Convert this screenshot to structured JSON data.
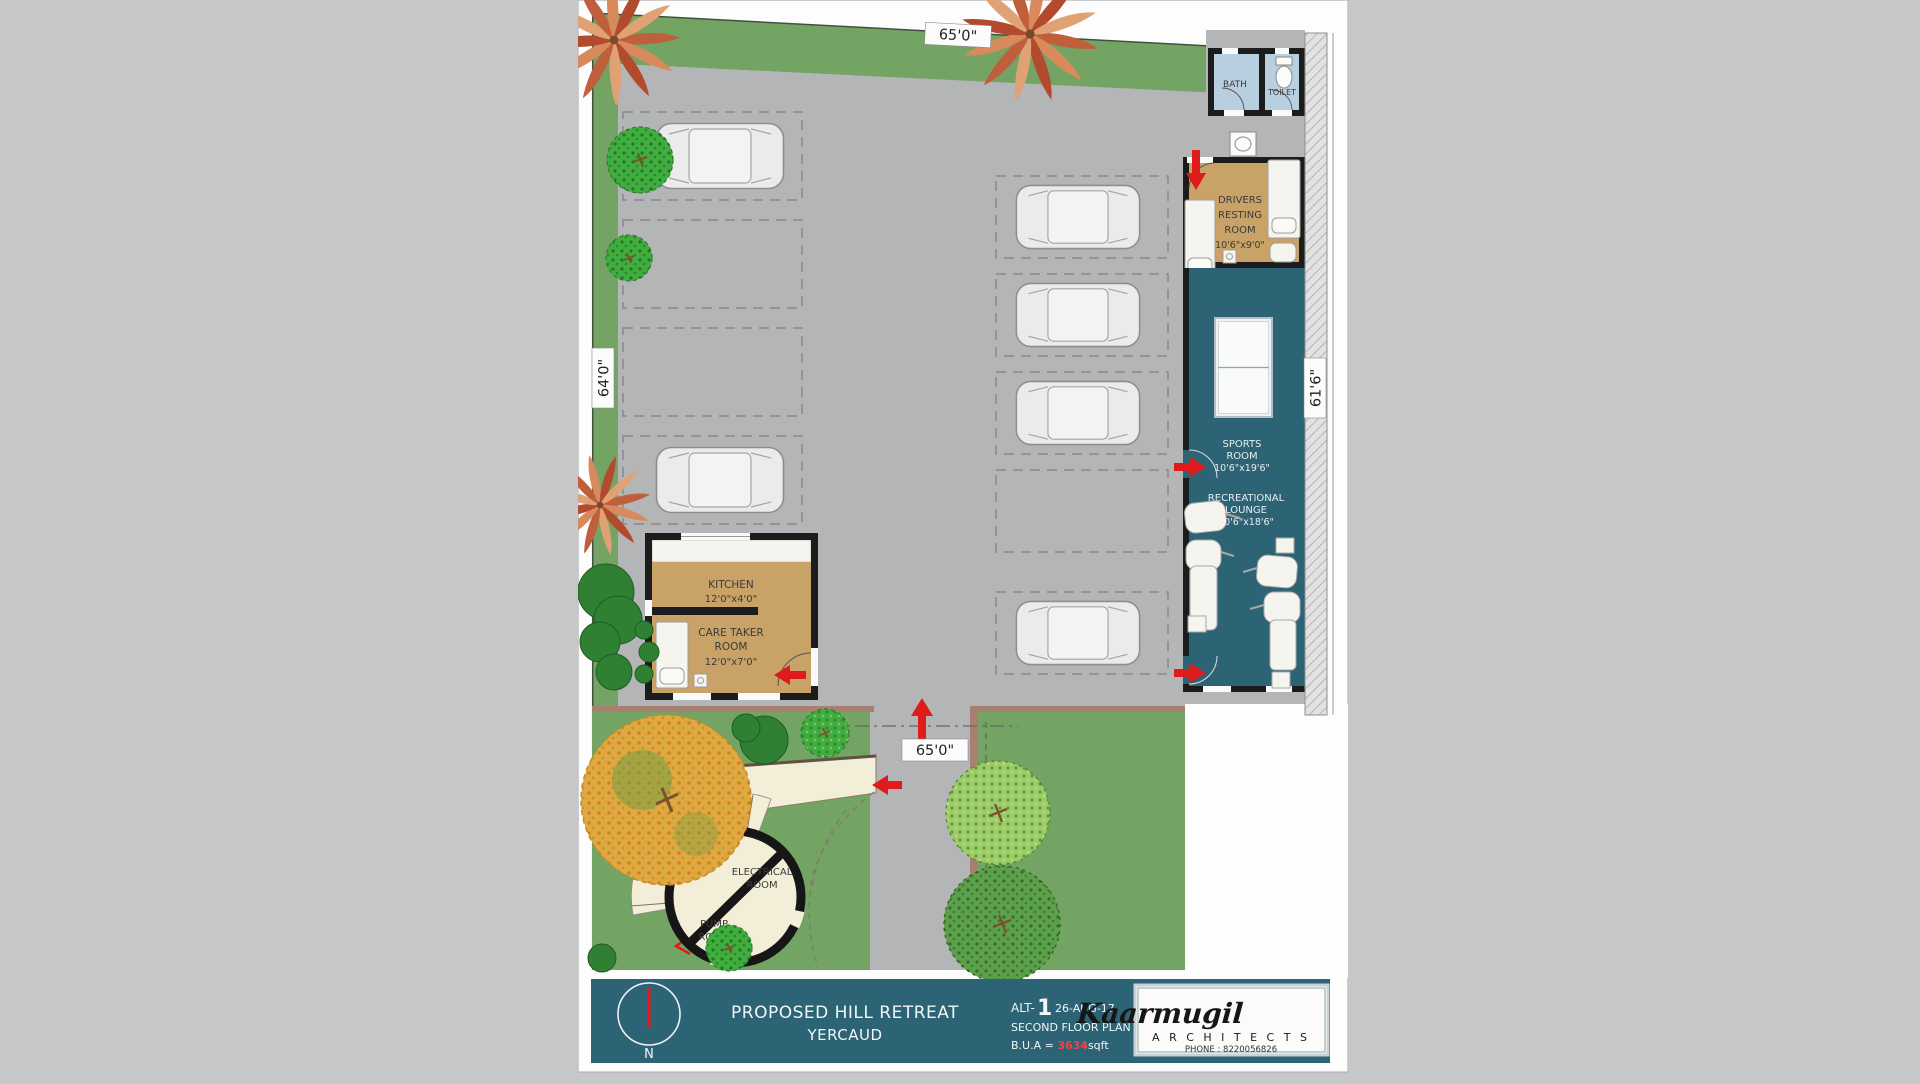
{
  "dims": {
    "top": "65'0\"",
    "left": "64'0\"",
    "bottom": "65'0\"",
    "right": "61'6\""
  },
  "rooms": {
    "bath": {
      "label": "BATH"
    },
    "toilet": {
      "label": "TOILET"
    },
    "drivers_resting": {
      "line1": "DRIVERS",
      "line2": "RESTING",
      "line3": "ROOM",
      "size": "10'6\"x9'0\""
    },
    "sports": {
      "line1": "SPORTS",
      "line2": "ROOM",
      "size": "10'6\"x19'6\""
    },
    "lounge": {
      "line1": "RECREATIONAL",
      "line2": "LOUNGE",
      "size": "10'6\"x18'6\""
    },
    "kitchen": {
      "line1": "KITCHEN",
      "size": "12'0\"x4'0\""
    },
    "caretaker": {
      "line1": "CARE TAKER",
      "line2": "ROOM",
      "size": "12'0\"x7'0\""
    },
    "electrical": {
      "line1": "ELECTRICAL",
      "line2": "ROOM"
    },
    "pump": {
      "line1": "PUMP",
      "line2": "ROOM"
    },
    "stair": {
      "up_label": "UP"
    }
  },
  "title_block": {
    "project_line1": "PROPOSED HILL RETREAT",
    "project_line2": "YERCAUD",
    "alt_prefix": "ALT-",
    "alt_number": "1",
    "date": "26-AUG-17",
    "plan_name": "SECOND FLOOR PLAN",
    "bua_prefix": "B.U.A = ",
    "bua_value": "3634",
    "bua_suffix": "sqft",
    "north_label": "N"
  },
  "logo": {
    "name": "Kaarmugil",
    "subtitle": "A R C H I T E C T S",
    "phone": "PHONE : 8220056826"
  },
  "colors": {
    "teal": "#2c6375",
    "site_green": "#74a464",
    "lot_gray": "#b4b5b7",
    "room_tan": "#c9a268",
    "bath_blue": "#b8cfdf",
    "cream": "#f3eed8",
    "arrow_red": "#e01b1b",
    "wall_black": "#1c1c1c",
    "boundary_brown": "#a88072",
    "page_gray": "#c6c7c9"
  }
}
